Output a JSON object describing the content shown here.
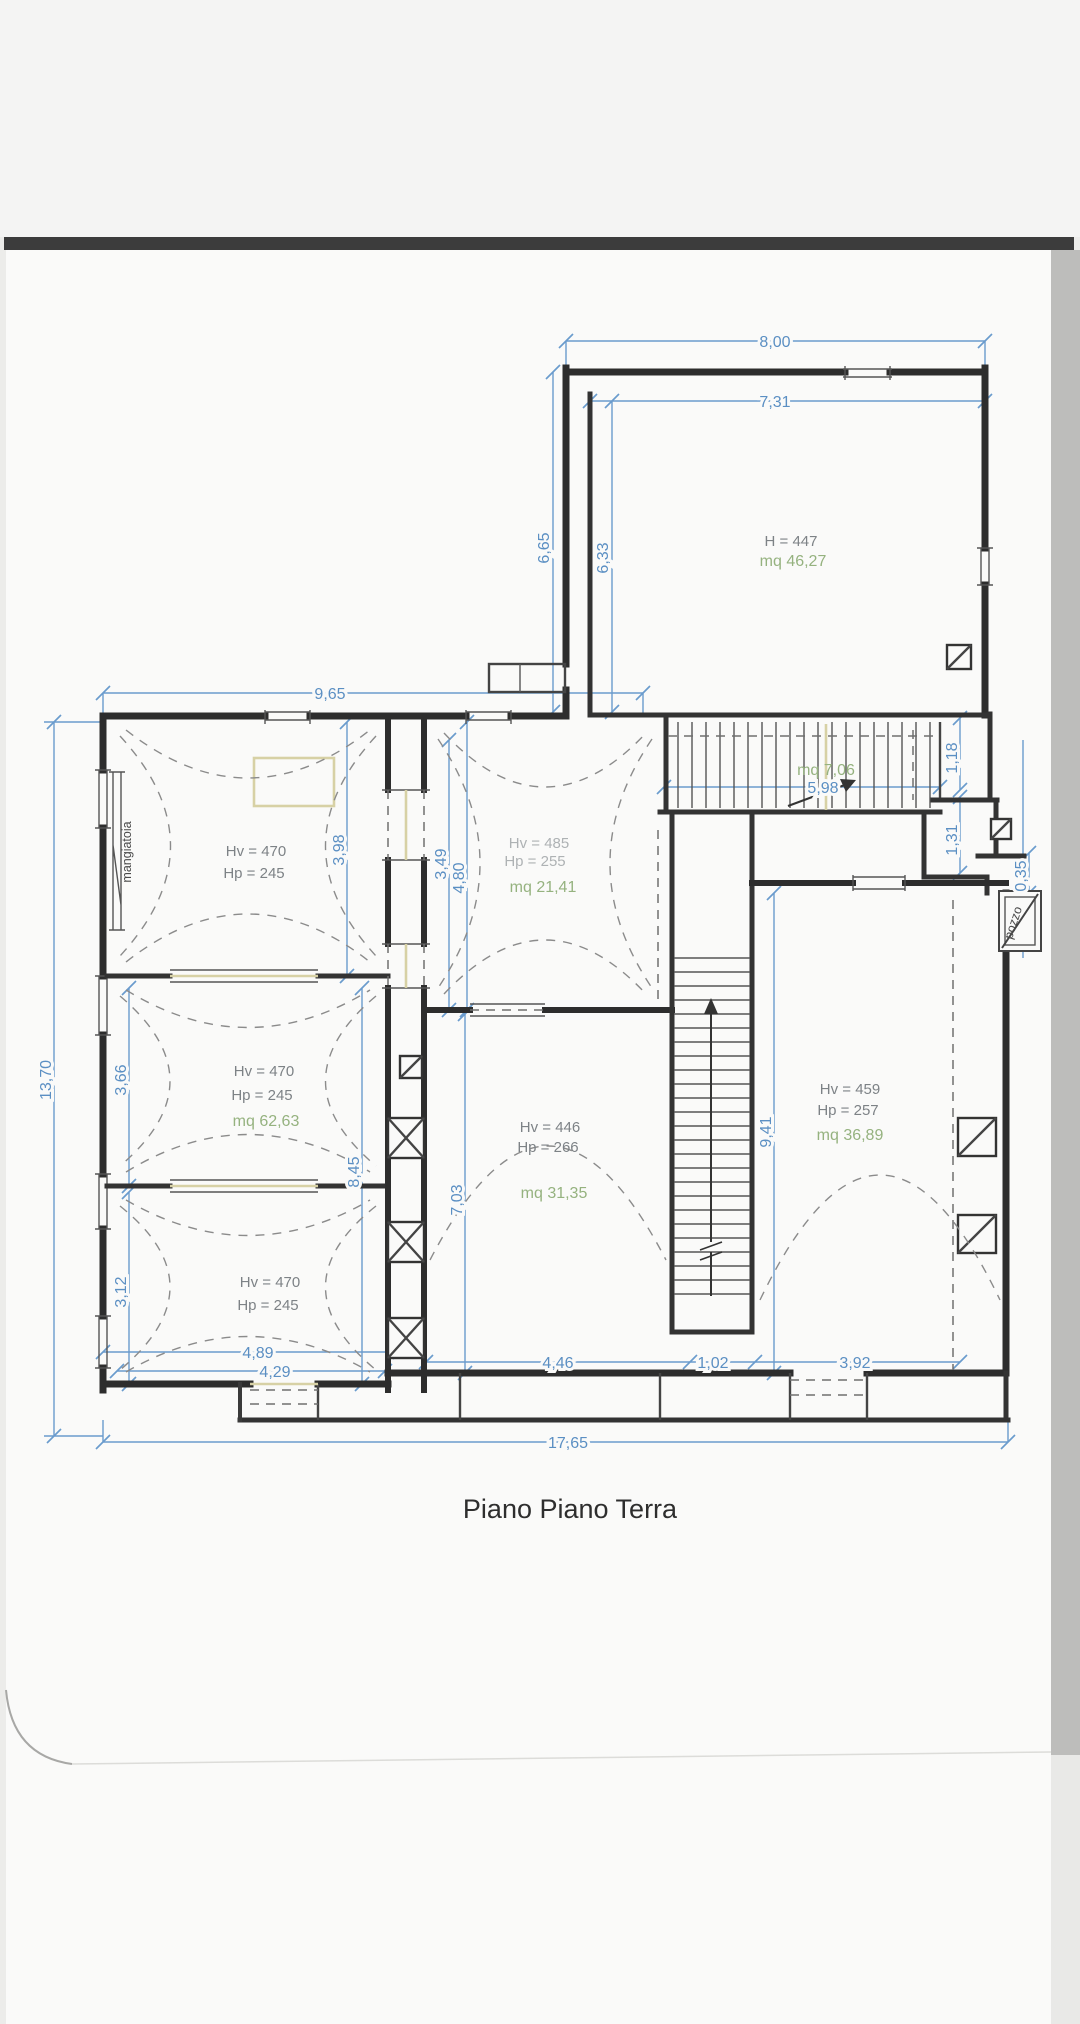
{
  "document": {
    "title": "Piano Piano Terra"
  },
  "rooms": {
    "annex": {
      "h": "H = 447",
      "mq": "mq 46,27"
    },
    "left_top": {
      "hv": "Hv = 470",
      "hp": "Hp = 245"
    },
    "left_middle": {
      "hv": "Hv = 470",
      "hp": "Hp = 245",
      "mq": "mq 62,63"
    },
    "left_bottom": {
      "hv": "Hv = 470",
      "hp": "Hp = 245"
    },
    "hall": {
      "hv": "Hv = 485",
      "hp": "Hp = 255",
      "mq": "mq 21,41"
    },
    "center": {
      "hv": "Hv = 446",
      "hp": "Hp = 266",
      "mq": "mq 31,35"
    },
    "right": {
      "hv": "Hv = 459",
      "hp": "Hp = 257",
      "mq": "mq 36,89"
    },
    "stairs": {
      "mq": "mq 7,06"
    }
  },
  "annotations": {
    "trough": "mangiatoia",
    "well": "pozzo"
  },
  "dimensions": {
    "d800": "8,00",
    "d731": "7,31",
    "d665": "6,65",
    "d633": "6,33",
    "d965": "9,65",
    "d1370": "13,70",
    "d398": "3,98",
    "d366": "3,66",
    "d312": "3,12",
    "d845": "8,45",
    "d349": "3,49",
    "d480": "4,80",
    "d703": "7,03",
    "d941": "9,41",
    "d598": "5,98",
    "d118": "1,18",
    "d131": "1,31",
    "d035": "0,35",
    "d489": "4,89",
    "d429": "4,29",
    "d446": "4,46",
    "d102": "1,02",
    "d392": "3,92",
    "d1765": "17,65"
  },
  "colors": {
    "dimension_blue": "#5b8fc3",
    "area_green": "#95b27f",
    "wall_dark": "#2d2d2d",
    "scan_band": "#3c3c3c",
    "paper": "#fafaf9"
  }
}
